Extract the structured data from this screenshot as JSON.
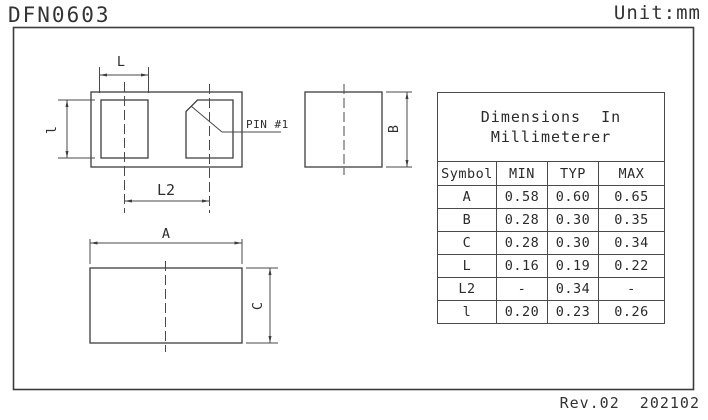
{
  "page": {
    "title": "DFN0603",
    "unit_label": "Unit:mm",
    "revision": "Rev.02  202102"
  },
  "labels": {
    "dim_L": "L",
    "dim_l": "l",
    "dim_L2": "L2",
    "pin1": "PIN #1",
    "dim_A": "A",
    "dim_B": "B",
    "dim_C": "C"
  },
  "table": {
    "title_line1": "Dimensions  In",
    "title_line2": "Millimeterer",
    "columns": [
      "Symbol",
      "MIN",
      "TYP",
      "MAX"
    ],
    "rows": [
      {
        "symbol": "A",
        "min": "0.58",
        "typ": "0.60",
        "max": "0.65"
      },
      {
        "symbol": "B",
        "min": "0.28",
        "typ": "0.30",
        "max": "0.35"
      },
      {
        "symbol": "C",
        "min": "0.28",
        "typ": "0.30",
        "max": "0.34"
      },
      {
        "symbol": "L",
        "min": "0.16",
        "typ": "0.19",
        "max": "0.22"
      },
      {
        "symbol": "L2",
        "min": "-",
        "typ": "0.34",
        "max": "-"
      },
      {
        "symbol": "l",
        "min": "0.20",
        "typ": "0.23",
        "max": "0.26"
      }
    ]
  }
}
